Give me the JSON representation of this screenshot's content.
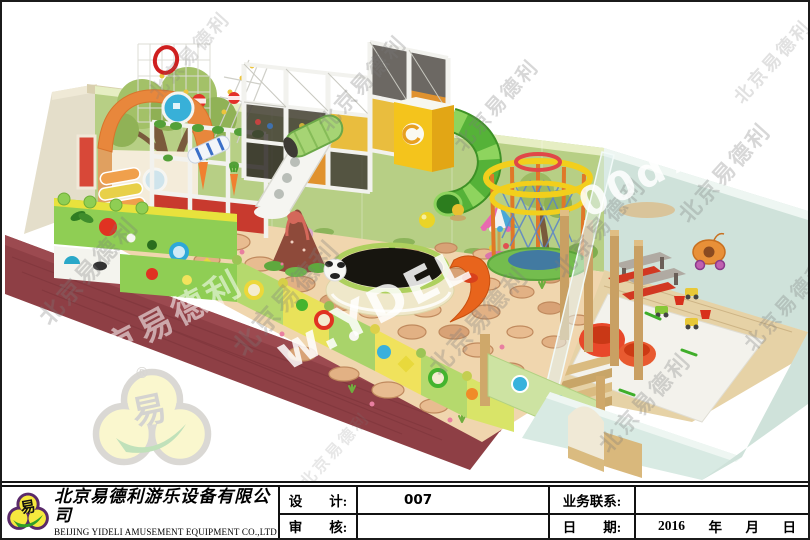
{
  "watermarks": {
    "diagonal_text": "北京易德利",
    "url_fragment_left": "w.YDEL",
    "url_fragment_right": "00d78",
    "registered_mark": "®"
  },
  "scene": {
    "colors": {
      "wall_green": "#b7cf85",
      "wall_trim": "#e6eec3",
      "side_wall_tan": "#e4decа",
      "carpet_maroon": "#8e3f45",
      "floor_base": "#f0d6ae",
      "stone": "#e0ad80",
      "fence_green": "#b5d96d",
      "fence_yellow": "#efe25c",
      "structure_white": "#f4f4f1",
      "net_dark": "#35302b",
      "tube_green": "#55b238",
      "tower_yellow": "#f2c21e",
      "canopy_orange": "#e8873c",
      "trampoline_black": "#17150f",
      "trampoline_ring_green": "#aed05e",
      "room_mint": "#cfe2da",
      "room_floor_wood": "#e6d2a6",
      "mat_white": "#f3f2ec",
      "beanbag_red": "#e8482a",
      "wood_post": "#c9a063",
      "slide_orange": "#e8641c",
      "ring_yellow": "#f2cf1c",
      "net_blue": "#5b85c8"
    }
  },
  "title_block": {
    "logo_char": "易",
    "company_cn": "北京易德利游乐设备有限公司",
    "company_en": "BEIJING YIDELI AMUSEMENT EQUIPMENT CO.,LTD",
    "design_label": "设　　计:",
    "design_value": "007",
    "review_label": "审　　核:",
    "review_value": "",
    "contact_label": "业务联系:",
    "contact_value": "",
    "date_label": "日　　期:",
    "date_parts": [
      "2016",
      "年",
      "月",
      "日"
    ]
  }
}
